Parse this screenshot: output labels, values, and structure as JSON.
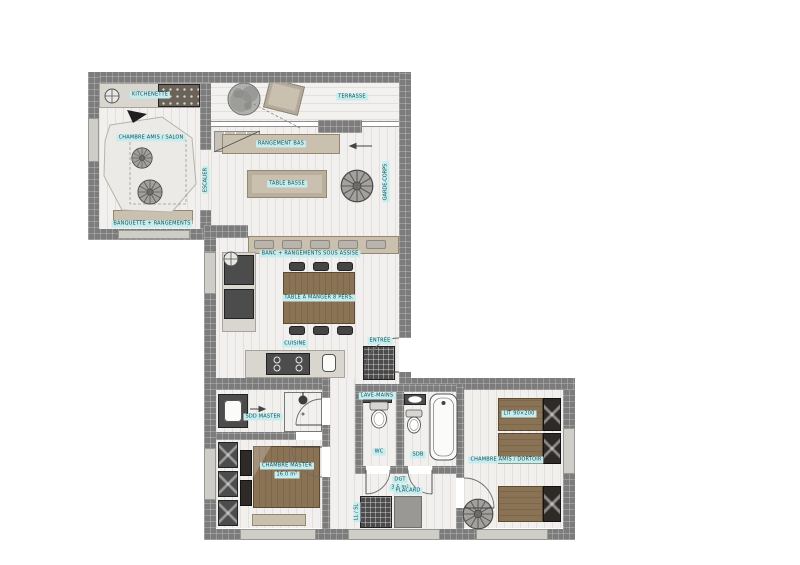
{
  "colors": {
    "wall": "#7c7c7c",
    "wood": "#8a7254",
    "tan": "#c9c0b0",
    "label_bg": "#c7ecee",
    "label_text": "#0a4f57"
  },
  "labels": {
    "kitchenette": "KITCHENETTE",
    "guest_room": "CHAMBRE AMIS / SALON",
    "guest_bench": "BANQUETTE + RANGEMENTS",
    "stairs": "ESCALIER",
    "terrace": "TERRASSE",
    "salon_storage": "RANGEMENT BAS",
    "coffee_table": "TABLE BASSE",
    "railing": "GARDE-CORPS",
    "dining_bench": "BANC + RANGEMENTS SOUS ASSISE",
    "dining_table": "TABLE À MANGER 8 PERS.",
    "kitchen": "CUISINE",
    "entry": "ENTRÉE",
    "sdd_master": "SDD MASTER",
    "master_room": "CHAMBRE MASTER",
    "master_area": "16.0 m²",
    "wc": "WC",
    "wc_shelf": "LAVE-MAINS",
    "sdb": "SDB",
    "corridor": "DGT",
    "corridor_area": "3.5 m²",
    "washer": "LL / SL",
    "closet": "PLACARD",
    "dortoir": "CHAMBRE AMIS / DORTOIR",
    "bed_size": "LIT 90×200"
  }
}
